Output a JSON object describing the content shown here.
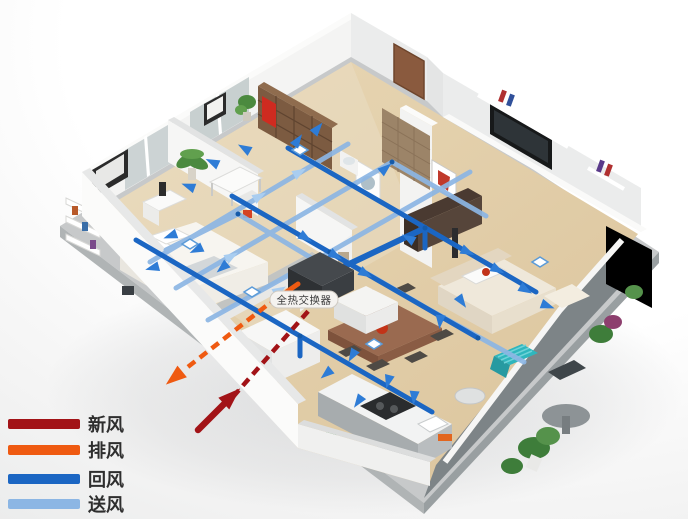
{
  "legend": {
    "items": [
      {
        "label": "新风",
        "color": "#a21317"
      },
      {
        "label": "排风",
        "color": "#ef5a11"
      },
      {
        "label": "回风",
        "color": "#1b66c3"
      },
      {
        "label": "送风",
        "color": "#8cb6e4"
      }
    ]
  },
  "device_label": {
    "text": "全热交换器"
  },
  "colors": {
    "fresh_air": "#a21317",
    "exhaust_air": "#ef5a11",
    "return_air": "#1b66c3",
    "supply_air": "#8cb6e4",
    "arrow_blue": "#2e7cd6",
    "floor_wood": "#e1cba4",
    "wall_white": "#f4f4f3",
    "base_gray": "#c7c9ca",
    "balcony_gray": "#7d8487"
  }
}
